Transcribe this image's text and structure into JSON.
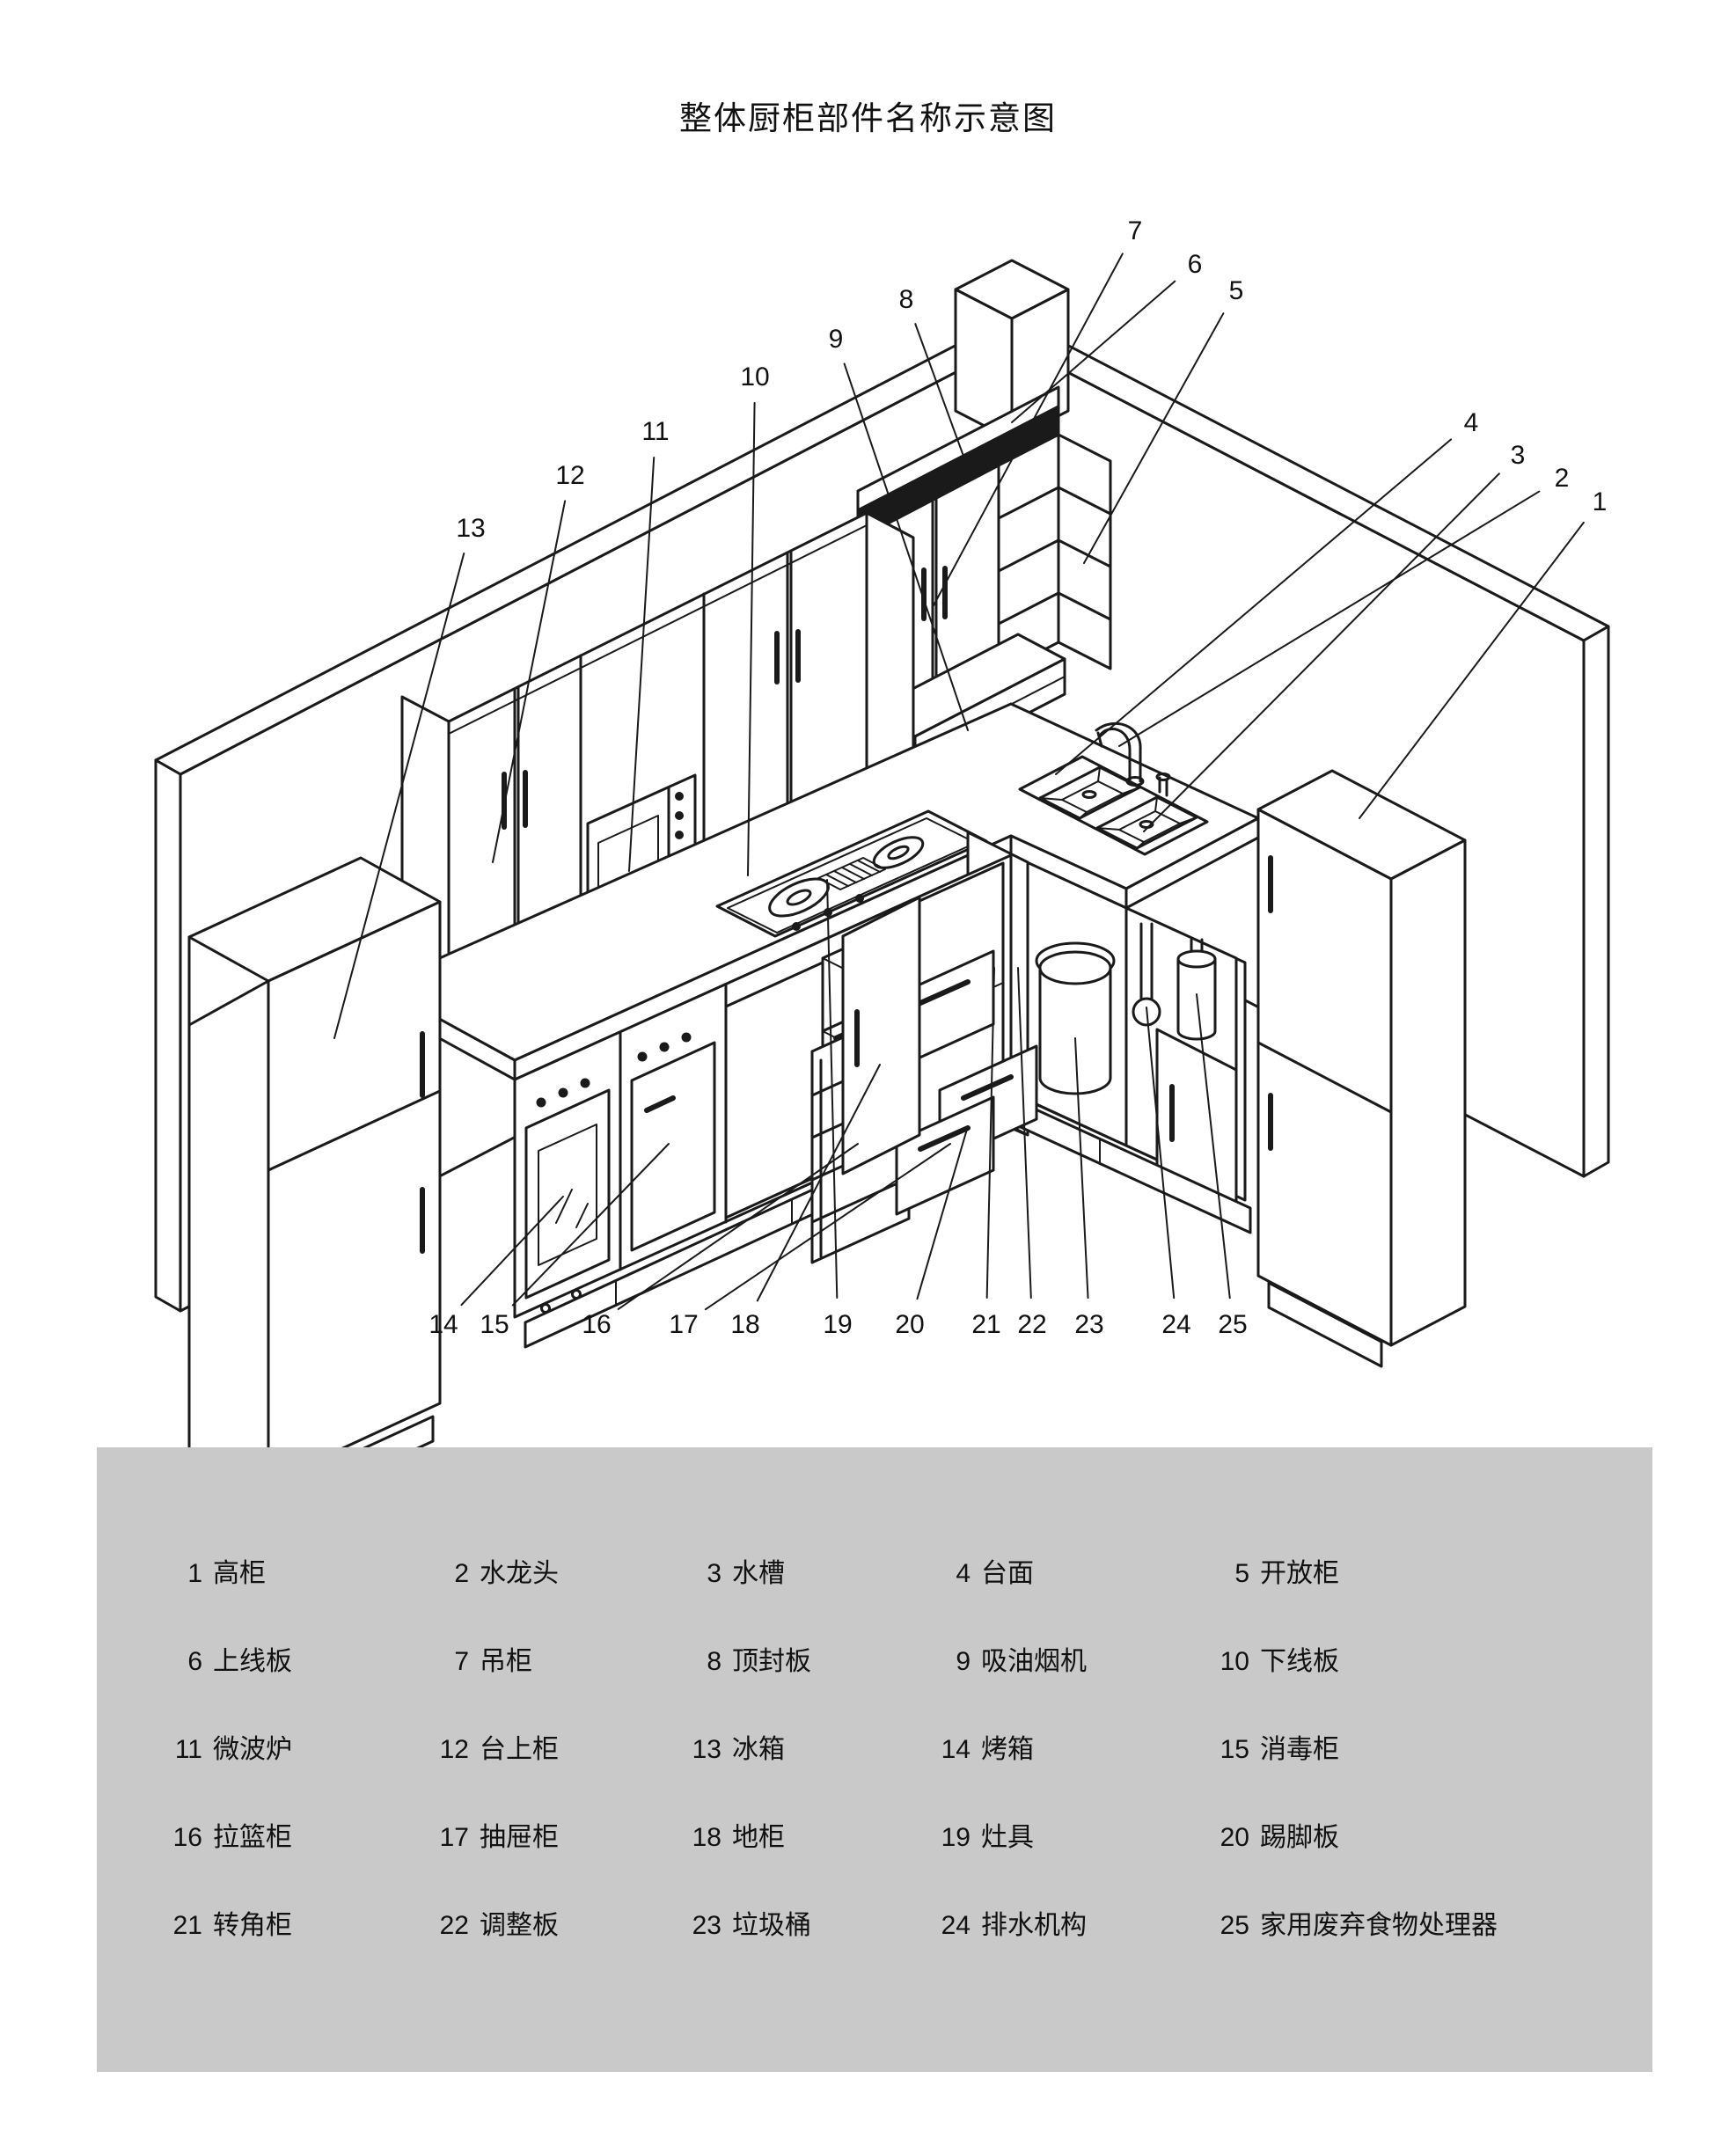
{
  "title": "整体厨柜部件名称示意图",
  "colors": {
    "line": "#1a1a1a",
    "legend_bg": "#c9c9c9",
    "paper": "#ffffff"
  },
  "legend": {
    "items": [
      {
        "n": "1",
        "name": "高柜"
      },
      {
        "n": "2",
        "name": "水龙头"
      },
      {
        "n": "3",
        "name": "水槽"
      },
      {
        "n": "4",
        "name": "台面"
      },
      {
        "n": "5",
        "name": "开放柜"
      },
      {
        "n": "6",
        "name": "上线板"
      },
      {
        "n": "7",
        "name": "吊柜"
      },
      {
        "n": "8",
        "name": "顶封板"
      },
      {
        "n": "9",
        "name": "吸油烟机"
      },
      {
        "n": "10",
        "name": "下线板"
      },
      {
        "n": "11",
        "name": "微波炉"
      },
      {
        "n": "12",
        "name": "台上柜"
      },
      {
        "n": "13",
        "name": "冰箱"
      },
      {
        "n": "14",
        "name": "烤箱"
      },
      {
        "n": "15",
        "name": "消毒柜"
      },
      {
        "n": "16",
        "name": "拉篮柜"
      },
      {
        "n": "17",
        "name": "抽屉柜"
      },
      {
        "n": "18",
        "name": "地柜"
      },
      {
        "n": "19",
        "name": "灶具"
      },
      {
        "n": "20",
        "name": "踢脚板"
      },
      {
        "n": "21",
        "name": "转角柜"
      },
      {
        "n": "22",
        "name": "调整板"
      },
      {
        "n": "23",
        "name": "垃圾桶"
      },
      {
        "n": "24",
        "name": "排水机构"
      },
      {
        "n": "25",
        "name": "家用废弃食物处理器"
      }
    ]
  },
  "diagram": {
    "callouts": [
      {
        "n": "1",
        "label": [
          1818,
          570
        ],
        "target": [
          1545,
          930
        ]
      },
      {
        "n": "2",
        "label": [
          1775,
          543
        ],
        "target": [
          1272,
          848
        ]
      },
      {
        "n": "3",
        "label": [
          1725,
          517
        ],
        "target": [
          1300,
          945
        ]
      },
      {
        "n": "4",
        "label": [
          1672,
          480
        ],
        "target": [
          1200,
          880
        ]
      },
      {
        "n": "5",
        "label": [
          1405,
          330
        ],
        "target": [
          1232,
          640
        ]
      },
      {
        "n": "6",
        "label": [
          1358,
          300
        ],
        "target": [
          1150,
          480
        ]
      },
      {
        "n": "7",
        "label": [
          1290,
          262
        ],
        "target": [
          1060,
          690
        ]
      },
      {
        "n": "8",
        "label": [
          1030,
          340
        ],
        "target": [
          1100,
          532
        ]
      },
      {
        "n": "9",
        "label": [
          950,
          385
        ],
        "target": [
          1100,
          830
        ]
      },
      {
        "n": "10",
        "label": [
          858,
          428
        ],
        "target": [
          850,
          995
        ]
      },
      {
        "n": "11",
        "label": [
          745,
          490
        ],
        "target": [
          715,
          990
        ]
      },
      {
        "n": "12",
        "label": [
          648,
          540
        ],
        "target": [
          560,
          980
        ]
      },
      {
        "n": "13",
        "label": [
          535,
          600
        ],
        "target": [
          380,
          1180
        ]
      },
      {
        "n": "14",
        "label": [
          504,
          1505
        ],
        "target": [
          640,
          1360
        ]
      },
      {
        "n": "15",
        "label": [
          562,
          1505
        ],
        "target": [
          760,
          1300
        ]
      },
      {
        "n": "16",
        "label": [
          678,
          1505
        ],
        "target": [
          975,
          1300
        ]
      },
      {
        "n": "17",
        "label": [
          777,
          1505
        ],
        "target": [
          1080,
          1300
        ]
      },
      {
        "n": "18",
        "label": [
          847,
          1505
        ],
        "target": [
          1000,
          1210
        ]
      },
      {
        "n": "19",
        "label": [
          952,
          1505
        ],
        "target": [
          940,
          1000
        ]
      },
      {
        "n": "20",
        "label": [
          1034,
          1505
        ],
        "target": [
          1100,
          1280
        ]
      },
      {
        "n": "21",
        "label": [
          1121,
          1505
        ],
        "target": [
          1130,
          1100
        ]
      },
      {
        "n": "22",
        "label": [
          1173,
          1505
        ],
        "target": [
          1157,
          1100
        ]
      },
      {
        "n": "23",
        "label": [
          1238,
          1505
        ],
        "target": [
          1222,
          1180
        ]
      },
      {
        "n": "24",
        "label": [
          1337,
          1505
        ],
        "target": [
          1303,
          1145
        ]
      },
      {
        "n": "25",
        "label": [
          1401,
          1505
        ],
        "target": [
          1360,
          1130
        ]
      }
    ]
  }
}
